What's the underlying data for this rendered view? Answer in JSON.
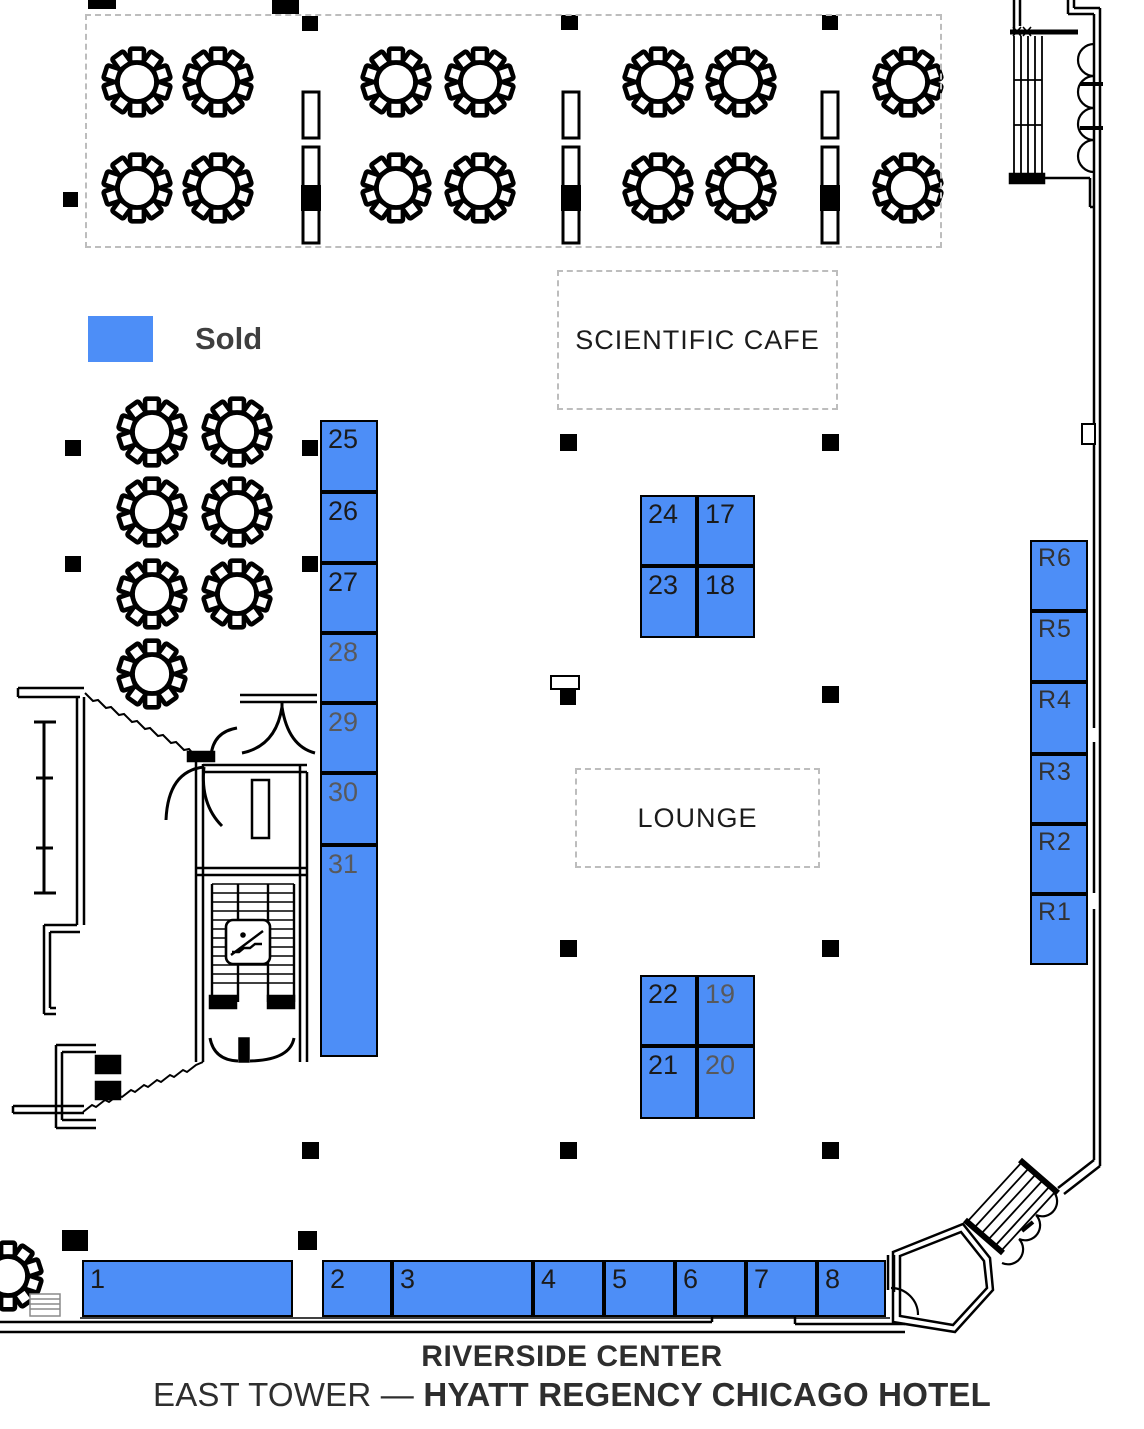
{
  "legend": {
    "sold_label": "Sold",
    "sold_color": "#4d8ef7"
  },
  "areas": {
    "scientific_cafe": "SCIENTIFIC CAFE",
    "lounge": "LOUNGE"
  },
  "booths": {
    "left": [
      "25",
      "26",
      "27",
      "28",
      "29",
      "30",
      "31"
    ],
    "island_top": [
      "24",
      "17",
      "23",
      "18"
    ],
    "island_bottom": [
      "22",
      "19",
      "21",
      "20"
    ],
    "right": [
      "R6",
      "R5",
      "R4",
      "R3",
      "R2",
      "R1"
    ],
    "front": [
      "1",
      "2",
      "3",
      "4",
      "5",
      "6",
      "7",
      "8"
    ]
  },
  "footer": {
    "venue": "RIVERSIDE CENTER",
    "tower": "EAST TOWER",
    "separator": "—",
    "hotel": "HYATT REGENCY CHICAGO HOTEL"
  }
}
